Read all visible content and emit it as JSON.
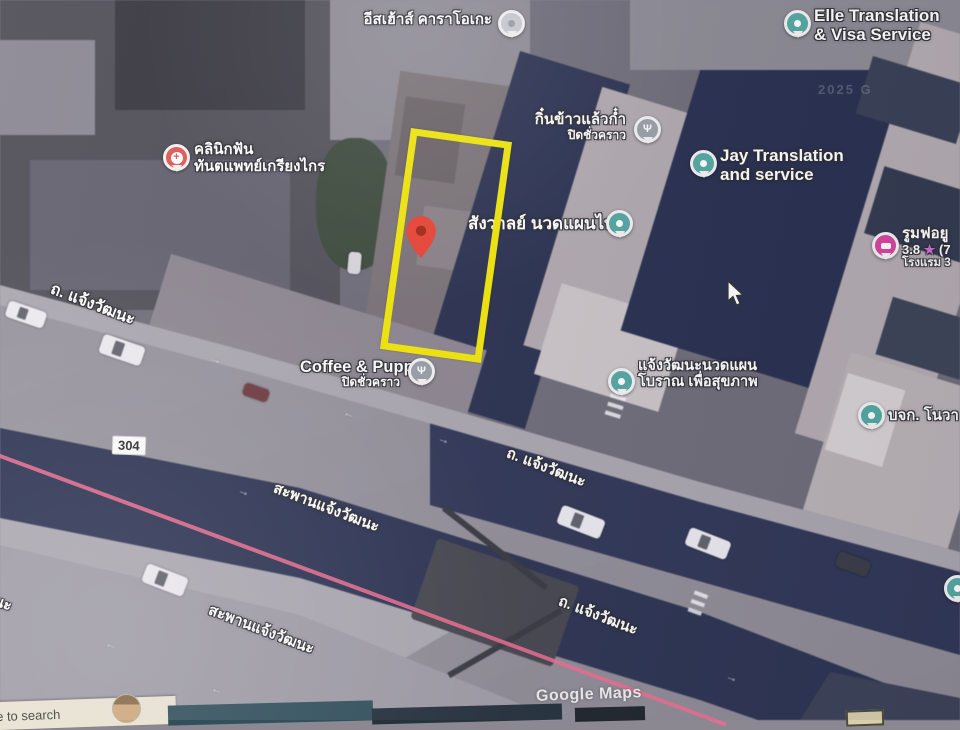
{
  "map": {
    "watermark": "Google Maps",
    "faint_watermark": "2025 G",
    "route_badge": "304",
    "road_names": [
      "ถ. แจ้งวัฒนะ",
      "สะพานแจ้งวัฒนะ",
      "วัฒนะ"
    ],
    "places": [
      {
        "name": "อีสเฮ้าส์ คาราโอเกะ",
        "line1": "อีสเฮ้าส์ คาราโอเกะ",
        "pin": "karaoke-grey-pin"
      },
      {
        "name": "Elle Translation & Visa Service",
        "line1": "Elle Translation",
        "line2": "& Visa Service",
        "pin": "teal-pin"
      },
      {
        "name": "คลินิกฟัน ทันตแพทย์เกรียงไกร",
        "line1": "คลินิกฟัน",
        "line2": "ทันตแพทย์เกรียงไกร",
        "pin": "health-red-pin"
      },
      {
        "name": "กิ๋นข้าวแล้วก๋ำ",
        "line1": "กิ๋นข้าวแล้วก๋ำ",
        "line2": "ปิดชั่วคราว",
        "pin": "restaurant-grey-pin"
      },
      {
        "name": "Jay Translation and service",
        "line1": "Jay Translation",
        "line2": "and service",
        "pin": "teal-pin"
      },
      {
        "name": "สังวาลย์ นวดแผนไทย",
        "line1": "สังวาลย์ นวดแผนไทย",
        "pin": "teal-pin"
      },
      {
        "name": "รูมฟอยู",
        "line1": "รูมฟอยู",
        "rating": "3.8",
        "star": "★",
        "review_count": "(7",
        "line3": "โรงแรม 3",
        "pin": "hotel-pink-pin"
      },
      {
        "name": "Coffee & Puppy",
        "line1": "Coffee & Puppy",
        "line2": "ปิดชั่วคราว",
        "pin": "restaurant-grey-pin"
      },
      {
        "name": "แจ้งวัฒนะนวดแผนโบราณ เพื่อสุขภาพ",
        "line1": "แจ้งวัฒนะนวดแผน",
        "line2": "โบราณ เพื่อสุขภาพ",
        "pin": "teal-pin"
      },
      {
        "name": "บจก. โนวา",
        "line1": "บจก. โนวา",
        "pin": "teal-pin"
      }
    ],
    "icons": {
      "fork_glyph": "Ψ",
      "cross_glyph": "+",
      "star_glyph": "★",
      "arrow_glyph": "→"
    },
    "colors": {
      "highlight_yellow": "#f2e70a",
      "marker_red": "#ea4335",
      "pin_teal": "#55a9a3",
      "pin_pink": "#d6459e",
      "pin_clinic_red": "#e05a57",
      "route_line_pink": "#ee6f91",
      "bridge_navy": "#2d3453",
      "road_grey": "#938f99"
    }
  },
  "taskbar": {
    "search_text": "e to search"
  }
}
